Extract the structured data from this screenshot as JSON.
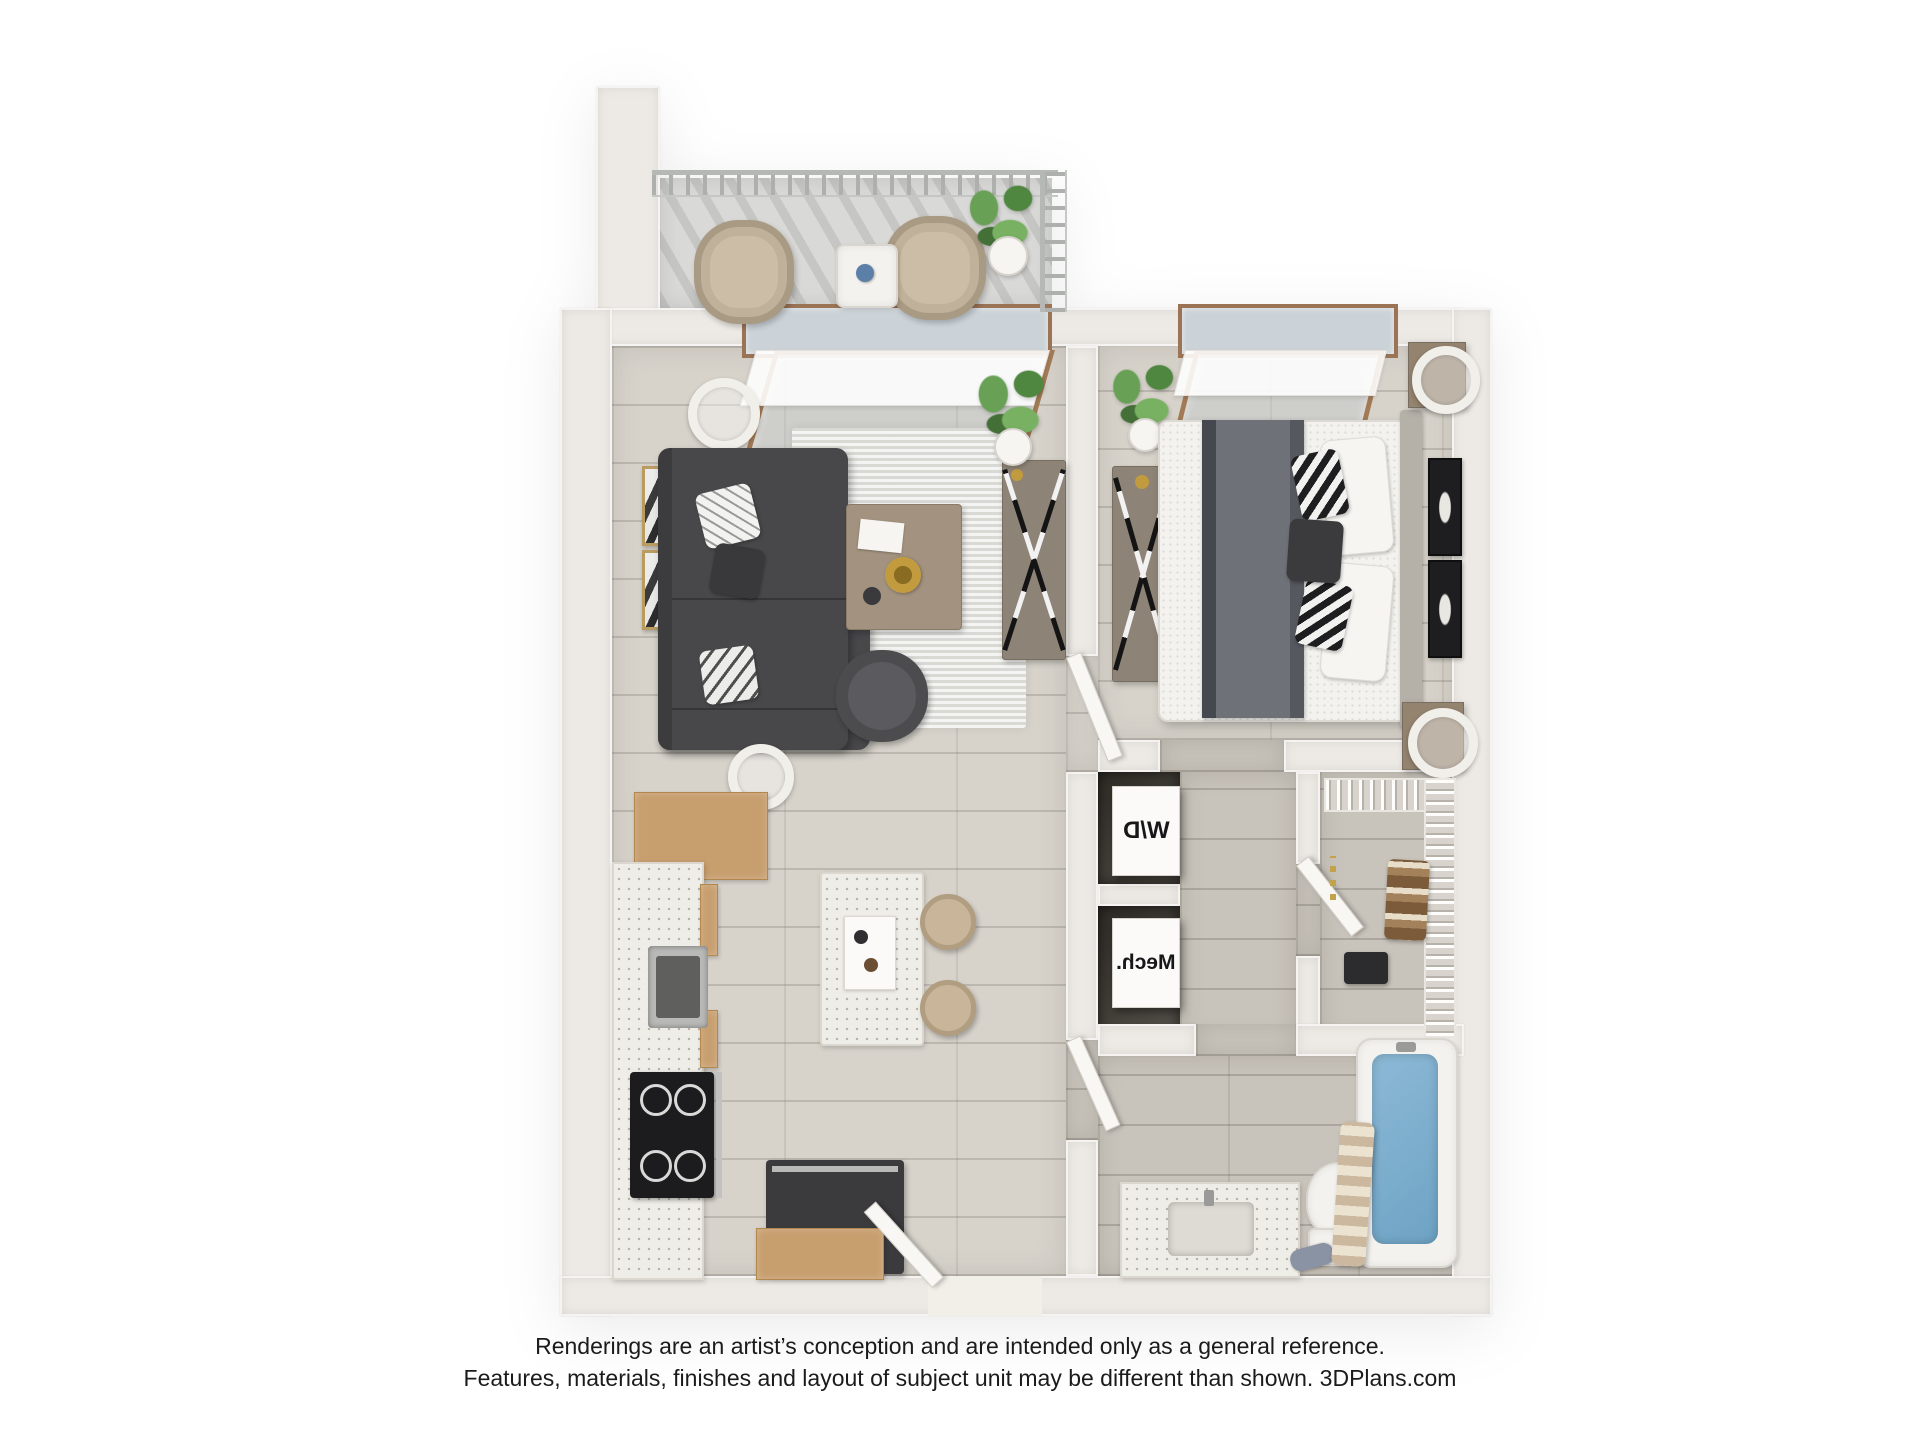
{
  "meta": {
    "type": "3d-floor-plan-rendering",
    "view": "top-down",
    "unit": "one-bedroom, one-bathroom apartment with balcony"
  },
  "labels": {
    "washer_dryer": "W/D",
    "mechanical": "Mech."
  },
  "disclaimer": {
    "line1": "Renderings are an artist’s conception and are intended only as a general reference.",
    "line2": "Features, materials, finishes and layout of subject unit may be different than shown. 3DPlans.com"
  },
  "branding": {
    "website": "3DPlans.com"
  },
  "rooms": [
    {
      "name": "Balcony",
      "contents": [
        "two wicker chairs",
        "side table",
        "potted plant",
        "metal railing"
      ]
    },
    {
      "name": "Living Room",
      "contents": [
        "dark gray sectional sofa with chaise",
        "area rug",
        "wood coffee table",
        "accent chair",
        "media console with X base",
        "two floor lamps",
        "two gold-framed artworks",
        "side table",
        "plant",
        "sliding glass window with roller shade"
      ]
    },
    {
      "name": "Kitchen",
      "contents": [
        "L-shaped counter with sink",
        "black cooktop",
        "refrigerator",
        "tan upper cabinets",
        "island with tray",
        "two stools",
        "entry door"
      ]
    },
    {
      "name": "Bedroom",
      "contents": [
        "bed with gray blanket",
        "headboard",
        "two nightstands with lamps",
        "dresser with X base",
        "two dark framed artworks",
        "plant",
        "window with roller shade"
      ]
    },
    {
      "name": "Laundry Closet",
      "contents": [
        "stacked washer/dryer box"
      ]
    },
    {
      "name": "Mechanical Closet",
      "contents": [
        "mechanical equipment box"
      ]
    },
    {
      "name": "Walk-in Closet",
      "contents": [
        "wire shelving",
        "hanging clothes",
        "suitcase"
      ]
    },
    {
      "name": "Bathroom",
      "contents": [
        "vanity with sink",
        "toilet",
        "bathtub with water",
        "striped shower curtain"
      ]
    }
  ],
  "colors": {
    "background": "#ffffff",
    "walls": "#edeae5",
    "floor_main": "#d7d3cb",
    "floor_wet": "#c9c4bb",
    "balcony_floor": "#d9d9d7",
    "sofa": "#48484b",
    "bed_blanket": "#6e7178",
    "cabinet_wood": "#c79e6e",
    "console_wood": "#8d8376",
    "appliance_black": "#2a2a2c",
    "tub_water": "#7fb0cf",
    "plant_green": "#5f9350",
    "window_frame": "#9b7355",
    "text": "#1b1b1b"
  }
}
